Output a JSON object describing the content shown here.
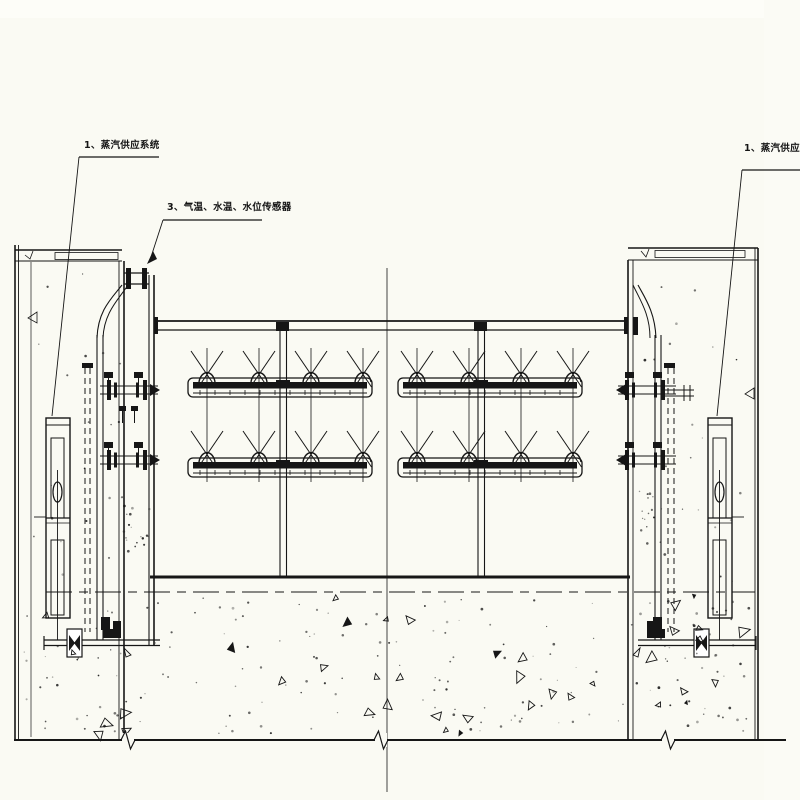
{
  "labels": {
    "steam_left": "1、蒸汽供应系统",
    "sensors": "3、气温、水温、水位传感器",
    "steam_right": "1、蒸汽供应系统"
  },
  "colors": {
    "line": "#161616",
    "background": "#fafaf3"
  }
}
